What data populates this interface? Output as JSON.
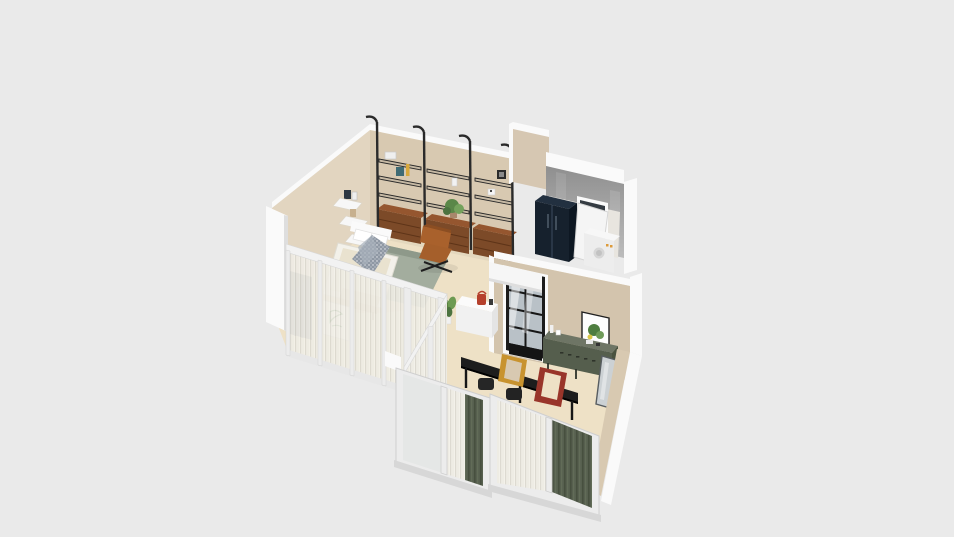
{
  "scene": {
    "label": "3D isometric apartment floor-plan render on plain gray background",
    "view": "axonometric top-down 3D cutaway",
    "background": "#eaeaea",
    "visible_text": "none"
  },
  "colors": {
    "bg": "#eaeaea",
    "floor": "#eee1c6",
    "wall_beige": "#e2d5c0",
    "wall_beige_dark": "#d8c9b1",
    "wall_tan": "#d6c7b2",
    "wall_white": "#fafafa",
    "wall_gray": "#a4a4a4",
    "glass_frame": "#ececec",
    "curtain_green": "#57604f",
    "fridge_navy": "#16212d",
    "walnut": "#7c4a28",
    "leather": "#a9612c",
    "sideboard_green": "#555e4d",
    "table_black": "#1d1d1d",
    "frame_orange": "#c8932f",
    "frame_red": "#99352a",
    "plant_green": "#5d8549",
    "pane_blue": "#b9c1c7",
    "shelf_black": "#2a2a2a",
    "bed_white": "#f3f1ea",
    "rug_sage": "#a3ad9e"
  },
  "rooms": [
    {
      "name": "study-living",
      "furniture": [
        "black-pole-wall-shelving-3-bays",
        "walnut-drawer-cabinets",
        "leather-butterfly-chair",
        "corner-wall-shelves-with-frames",
        "potted-plant-on-cabinet",
        "books-and-vases-on-shelves"
      ]
    },
    {
      "name": "bedroom",
      "furniture": [
        "platform-bed",
        "pillows",
        "patterned-blanket",
        "sage-bedspread",
        "foot-bench",
        "sheer-curtain-glass-walls",
        "plant-sketch-board",
        "dark-blinds-panel"
      ]
    },
    {
      "name": "utility-kitchen",
      "furniture": [
        "concrete-gray-wall",
        "window",
        "navy-refrigerator",
        "white-leaning-panel",
        "white-appliance",
        "white-side-cabinet"
      ]
    },
    {
      "name": "dining-living",
      "furniture": [
        "black-dining-table",
        "dark-chairs",
        "green-sideboard",
        "botanical-print",
        "black-grid-window-door",
        "white-kitchen-counter",
        "red-kettle",
        "orange-leaning-frame",
        "red-leaning-frame",
        "leaning-mirror",
        "tall-potted-plant",
        "sliding-glass-door-unit-left",
        "sliding-glass-door-unit-right",
        "dark-green-curtains",
        "small-floor-plant"
      ]
    }
  ]
}
